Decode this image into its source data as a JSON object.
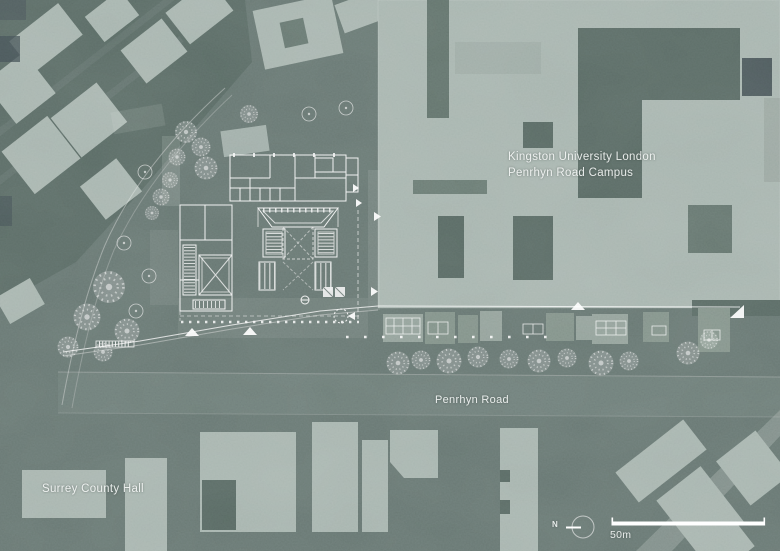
{
  "title": {
    "line1": "Kingston University London",
    "line2": "Penrhyn Road Campus"
  },
  "road_label": "Penrhyn Road",
  "building_label": "Surrey County Hall",
  "compass": {
    "label": "N"
  },
  "scale_bar": {
    "label": "50m"
  },
  "colors": {
    "background": "#5e6c68",
    "ground_dark": "#51605b",
    "building_light": "#9fada7",
    "building_mid": "#8a9992",
    "building_row": "#78887f",
    "shadow_dark": "#3d484d",
    "linework": "#ffffff"
  }
}
